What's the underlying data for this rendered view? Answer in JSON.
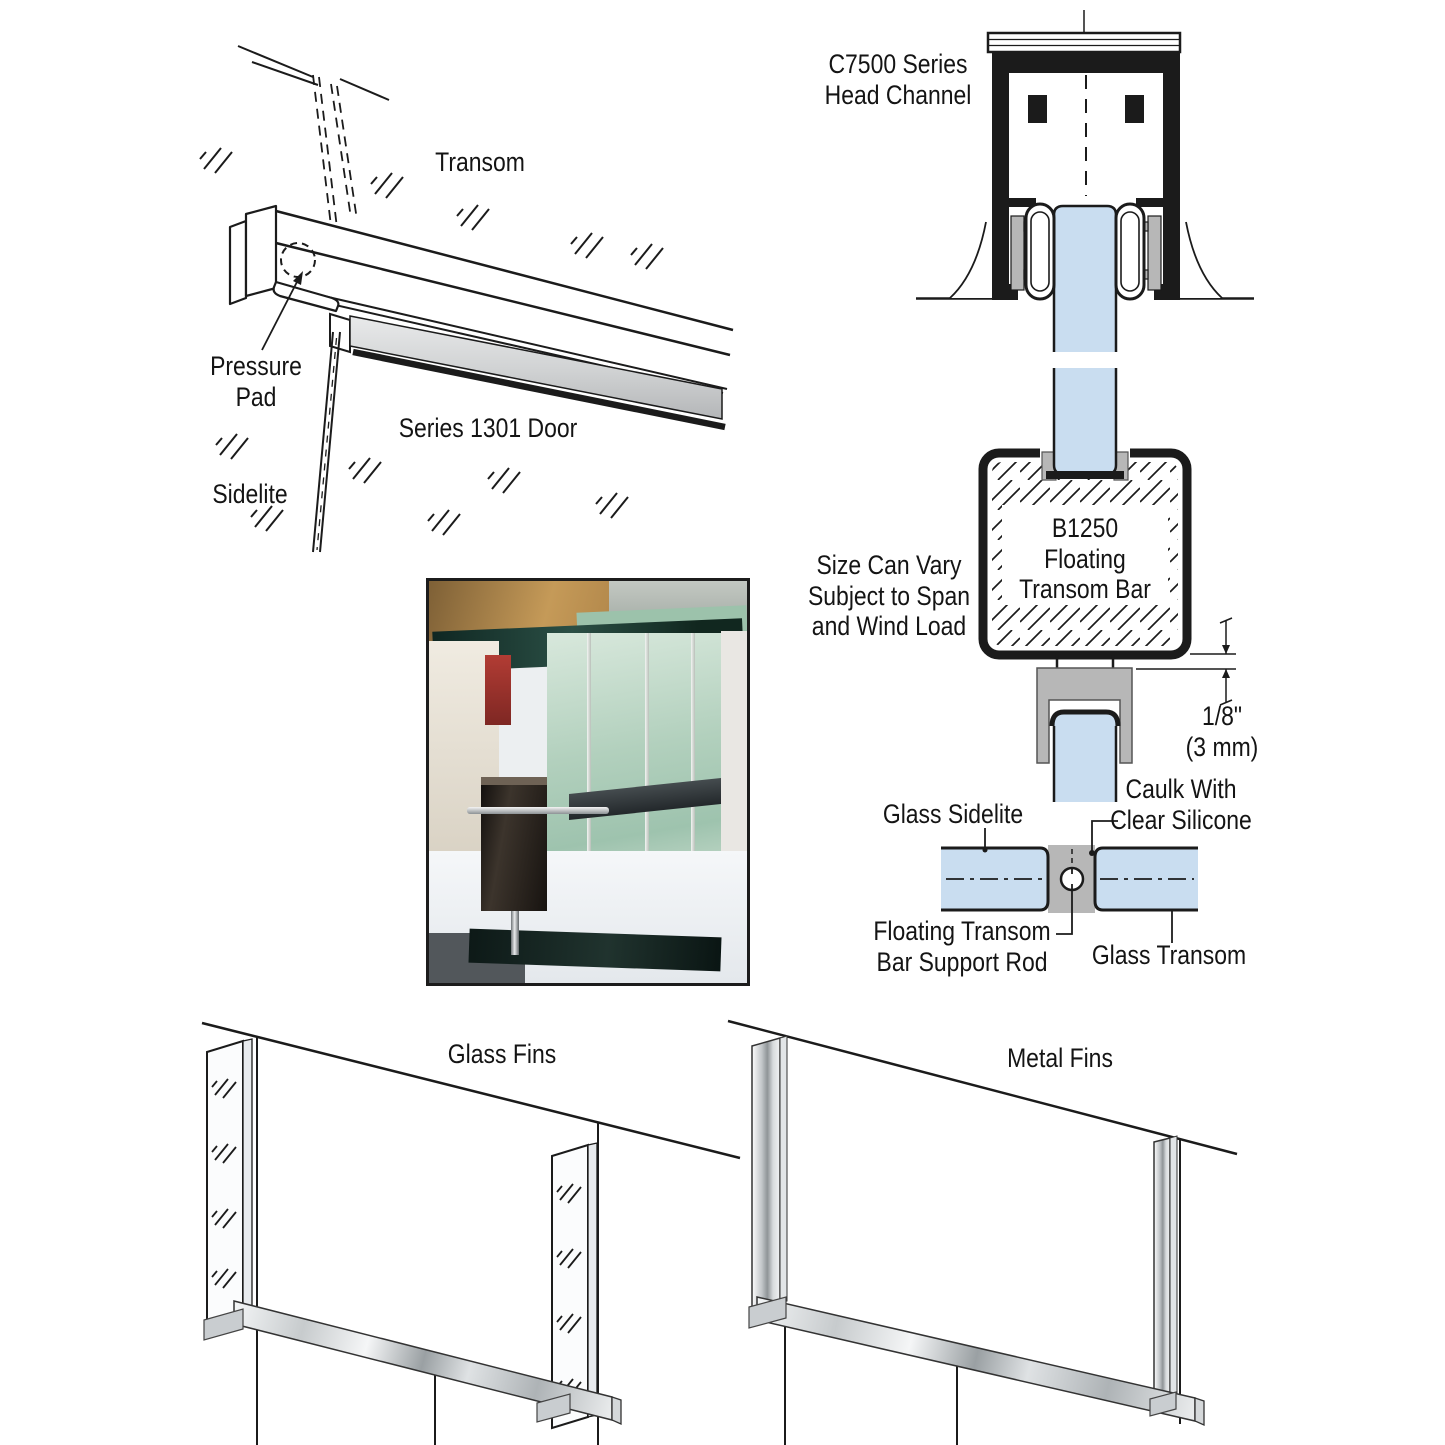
{
  "colors": {
    "glass_blue": "#c9ddf0",
    "hardware_gray": "#b7b7b7",
    "ink": "#1b1b1b",
    "metal_highlight": "#f2f4f5"
  },
  "iso": {
    "transom": "Transom",
    "pressure_pad_lines": [
      "Pressure",
      "Pad"
    ],
    "series_door": "Series 1301 Door",
    "sidelite": "Sidelite"
  },
  "section": {
    "head_channel_lines": [
      "C7500 Series",
      "Head Channel"
    ],
    "size_note_lines": [
      "Size Can Vary",
      "Subject to Span",
      "and Wind Load"
    ],
    "bar_lines": [
      "B1250",
      "Floating",
      "Transom Bar"
    ],
    "dimension_lines": [
      "1/8\"",
      "(3 mm)"
    ],
    "glass_sidelite": "Glass Sidelite",
    "caulk_lines": [
      "Caulk With",
      "Clear Silicone"
    ],
    "support_rod_lines": [
      "Floating Transom",
      "Bar Support Rod"
    ],
    "glass_transom": "Glass Transom"
  },
  "fins": {
    "glass_label": "Glass Fins",
    "metal_label": "Metal Fins"
  }
}
